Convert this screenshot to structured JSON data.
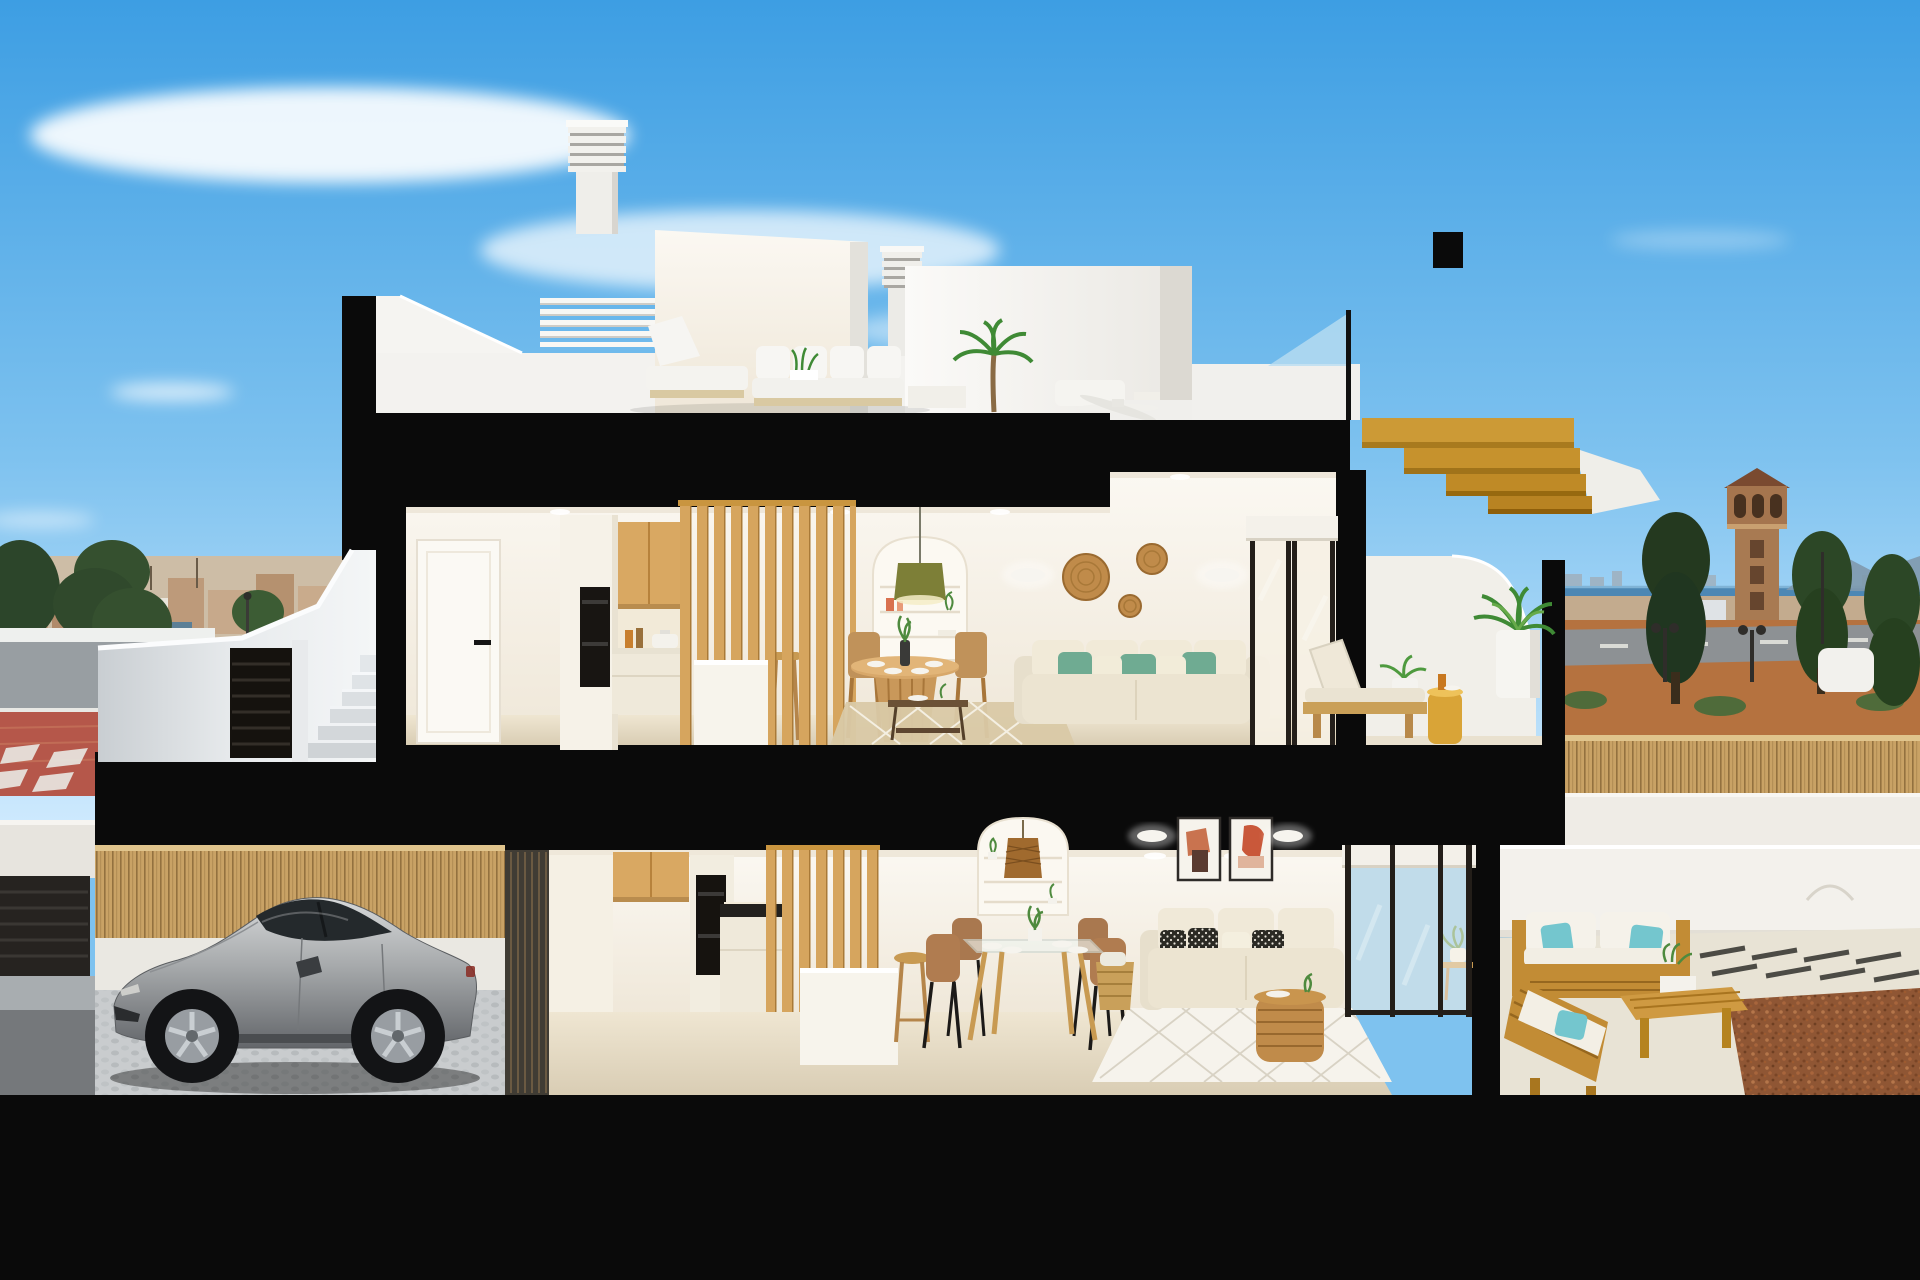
{
  "meta": {
    "kind": "architectural-cross-section-render",
    "canvas": {
      "width": 1920,
      "height": 1280
    },
    "description": "Cutaway 3D render of a two-storey coastal townhouse: roof terrace with chimneys and lounge set, upper open-plan living floor, ground living floor, street-level garage with a silver sports coupe, rear teak terrace, and sea-view surroundings."
  },
  "palette": {
    "sky_top": "#3d9ee3",
    "sky_bottom": "#cfeafe",
    "cloud": "#ffffff",
    "cut_black": "#0a0a0a",
    "exterior_white": "#f3f1ec",
    "interior_wall": "#f7f2e8",
    "interior_floor": "#e6dcc4",
    "wood_cabinet": "#d9a862",
    "wood_slat": "#d6a55e",
    "wood_gold": "#c8932f",
    "outdoor_wood": "#c28c35",
    "sofa_cream": "#ece4d1",
    "teal_pillow": "#6fab92",
    "turquoise_pillow": "#74c6ce",
    "brown_chair": "#a9784f",
    "rattan": "#c08b4a",
    "olive_pendant": "#7d7f37",
    "sea": "#4c87b4",
    "terrain": "#b5723f",
    "gravel": "#8f5634",
    "tree_green": "#2c452a",
    "palm_green": "#3f8a35",
    "bamboo_fence": "#c9a265",
    "street_gray": "#989ea2",
    "sidewalk_red": "#b5574a",
    "sign_blue": "#2463b8",
    "car_silver": "#aeb1b3",
    "glass_blue": "#b9ddf1",
    "concrete_stair": "#d3d7da",
    "tower_brown": "#a5754e",
    "art_terracotta": "#c9583a"
  },
  "scene": {
    "sky": {
      "clouds": [
        "large wispy cloud upper left",
        "soft cloud band center",
        "small lens cloud left"
      ]
    },
    "background_left": {
      "elements": [
        "distant hillside town",
        "dark conifer trees",
        "white guard wall",
        "gray road",
        "red paved sidewalk",
        "pedestrian crosswalk",
        "blue circular road sign",
        "street lamps"
      ]
    },
    "background_right": {
      "elements": [
        "sea horizon",
        "distant coastal skyline",
        "mountain ridge",
        "brown watchtower",
        "conifer trees",
        "dirt terrain",
        "gray road with lane dashes",
        "street lamps",
        "bamboo boundary fence",
        "white plot wall"
      ]
    },
    "rooftop": {
      "elements": [
        "tall louvered chimney stack",
        "small louvered chimney",
        "stair bulkhead volume",
        "white pergola slats",
        "outdoor lounge set with white cushions",
        "potted palm",
        "white sun lounger",
        "ceiling fan",
        "glass railing with black post",
        "golden wood exterior stair"
      ]
    },
    "upper_floor": {
      "rooms": [
        "hallway",
        "kitchen",
        "dining area",
        "living room",
        "sea-view terrace"
      ],
      "elements": [
        "white interior door with black handle",
        "tall cabinet with built-in oven",
        "oak upper cabinets",
        "cooking pot and bottles on counter",
        "vertical wood slat partition",
        "white kitchen island",
        "wooden bar stool",
        "round pedestal dining table with four wooden chairs",
        "arched wall niche with shelves",
        "olive pendant lamp",
        "cream sofa with sage green pillows",
        "glass coffee table",
        "jute rug",
        "two wall sconces",
        "three rattan wall plates",
        "sliding glass door with roller blind",
        "sun lounger with beige cushion",
        "mustard cylinder side table",
        "potted palm in white planter",
        "curved white parapet"
      ]
    },
    "ground_floor": {
      "rooms": [
        "kitchen",
        "dining area",
        "living room",
        "rear terrace"
      ],
      "elements": [
        "dark slatted divider wall",
        "oak upper cabinets",
        "built-in double oven",
        "black hob counter",
        "vertical wood slat partition",
        "white island with wooden stools",
        "glass dining table with four brown chairs",
        "arched niche with rattan pendant lamp",
        "two framed abstract artworks",
        "two wall sconces",
        "cream sofa with black-and-white patterned pillows",
        "woven storage basket",
        "diamond-pattern rug",
        "round rattan coffee table",
        "sliding glass doors with roller blind",
        "plant on wooden side table"
      ]
    },
    "rear_terrace": {
      "elements": [
        "teak outdoor sofa with white cushions",
        "turquoise throw pillows",
        "teak chaise",
        "slatted teak bench table with planter box",
        "light concrete deck",
        "dark paving strips",
        "red gravel bed",
        "white curved boundary wall"
      ]
    },
    "garage": {
      "elements": [
        "silver sports coupe",
        "bamboo privacy fence",
        "cobblestone floor",
        "car shadow"
      ]
    },
    "street_level": {
      "elements": [
        "white exterior staircase with parapet",
        "concrete steps",
        "black louvered gate",
        "neighbor louvered garage gate",
        "white street wall",
        "dark ground shadow band"
      ]
    }
  }
}
